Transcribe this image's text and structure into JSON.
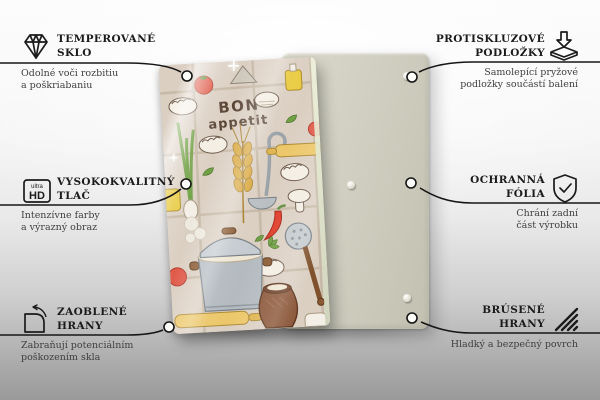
{
  "product": {
    "front_text_line1": "BON",
    "front_text_line2": "appetit",
    "front_panel_bg": "#dbcfc2",
    "back_panel_color": "#cfcec0",
    "illustration_items": [
      "tomato",
      "pierogi-dumplings",
      "green-onion",
      "wheat-ear",
      "ladle",
      "rolling-pin",
      "chili-pepper",
      "stock-pot",
      "clay-jug",
      "skimmer",
      "mushrooms",
      "oil-bottle",
      "herb-leaves",
      "salt-pile",
      "steam",
      "milk-jug"
    ]
  },
  "features": {
    "top_left": {
      "icon": "diamond-icon",
      "title_line1": "TEMPEROVANÉ",
      "title_line2": "SKLO",
      "desc_line1": "Odolné voči rozbitiu",
      "desc_line2": "a poškriabaniu"
    },
    "top_right": {
      "icon": "anti-slip-pads-icon",
      "title_line1": "PROTISKLUZOVÉ",
      "title_line2": "PODLOŽKY",
      "desc_line1": "Samolepící pryžové",
      "desc_line2": "podložky součástí balení"
    },
    "mid_left": {
      "icon": "ultra-hd-icon",
      "icon_text_top": "ultra",
      "icon_text_bottom": "HD",
      "title_line1": "VYSOKOKVALITNÝ",
      "title_line2": "TLAČ",
      "desc_line1": "Intenzívne farby",
      "desc_line2": "a výrazný obraz"
    },
    "mid_right": {
      "icon": "shield-check-icon",
      "title_line1": "OCHRANNÁ",
      "title_line2": "FÓLIA",
      "desc_line1": "Chrání zadní",
      "desc_line2": "část výrobku"
    },
    "bottom_left": {
      "icon": "rounded-corner-icon",
      "title_line1": "ZAOBLENÉ",
      "title_line2": "HRANY",
      "desc_line1": "Zabraňují potenciálním",
      "desc_line2": "poškozením skla"
    },
    "bottom_right": {
      "icon": "ground-edges-icon",
      "title_line1": "BRÚSENÉ",
      "title_line2": "HRANY",
      "desc_line1": "Hladký a bezpečný povrch"
    }
  }
}
